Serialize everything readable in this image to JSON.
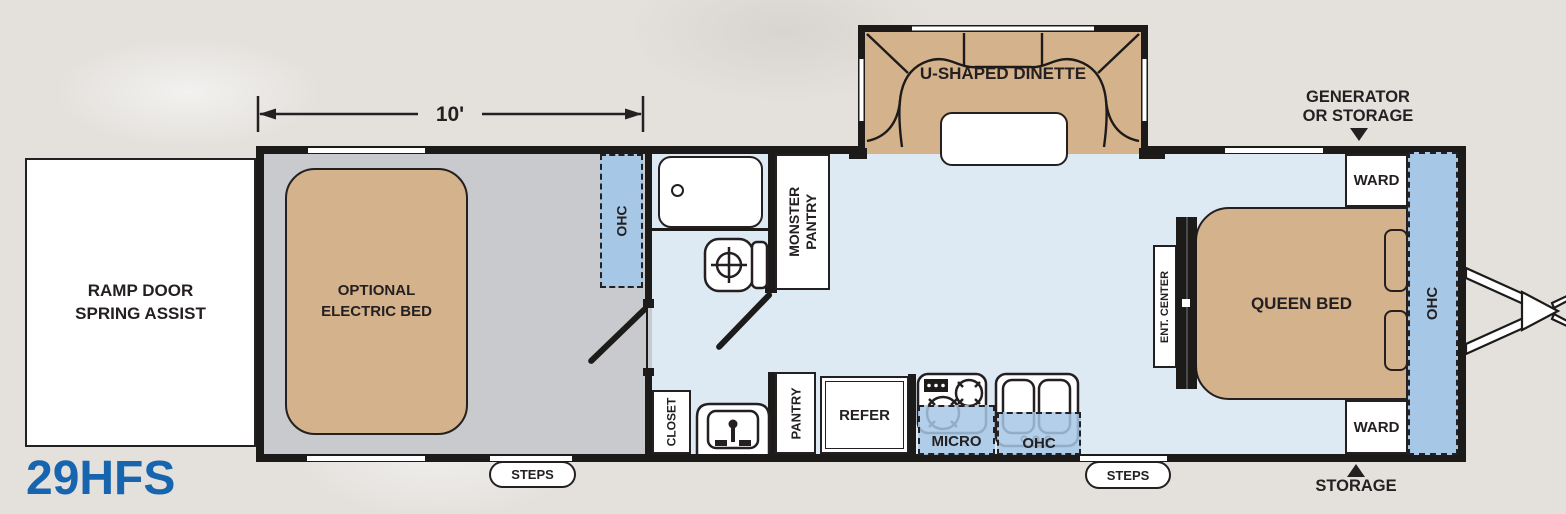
{
  "model": {
    "label": "29HFS",
    "color": "#1665ae"
  },
  "dimension": {
    "label": "10'"
  },
  "colors": {
    "background": "#e4e1dd",
    "wall": "#1d1b1a",
    "garage_floor": "#c9cacd",
    "main_floor": "#dde9f3",
    "cabinet_blue": "#a6c7e5",
    "furniture_tan": "#d4b28c",
    "text": "#241f20",
    "model_blue": "#1665ae"
  },
  "exterior": {
    "ramp_door_line1": "RAMP DOOR",
    "ramp_door_line2": "SPRING ASSIST",
    "generator_line1": "GENERATOR",
    "generator_line2": "OR STORAGE",
    "storage_label": "STORAGE",
    "steps_label": "STEPS"
  },
  "garage": {
    "bed_line1": "OPTIONAL",
    "bed_line2": "ELECTRIC BED",
    "ohc_label": "OHC"
  },
  "bath": {
    "pantry_line1": "MONSTER",
    "pantry_line2": "PANTRY",
    "closet_label": "CLOSET"
  },
  "living": {
    "dinette_label": "U-SHAPED DINETTE"
  },
  "kitchen": {
    "pantry_label": "PANTRY",
    "refer_label": "REFER",
    "micro_label": "MICRO",
    "ohc_label": "OHC"
  },
  "bedroom": {
    "queen_bed_label": "QUEEN BED",
    "ent_center_label": "ENT. CENTER",
    "ward_label": "WARD",
    "ohc_label": "OHC"
  }
}
